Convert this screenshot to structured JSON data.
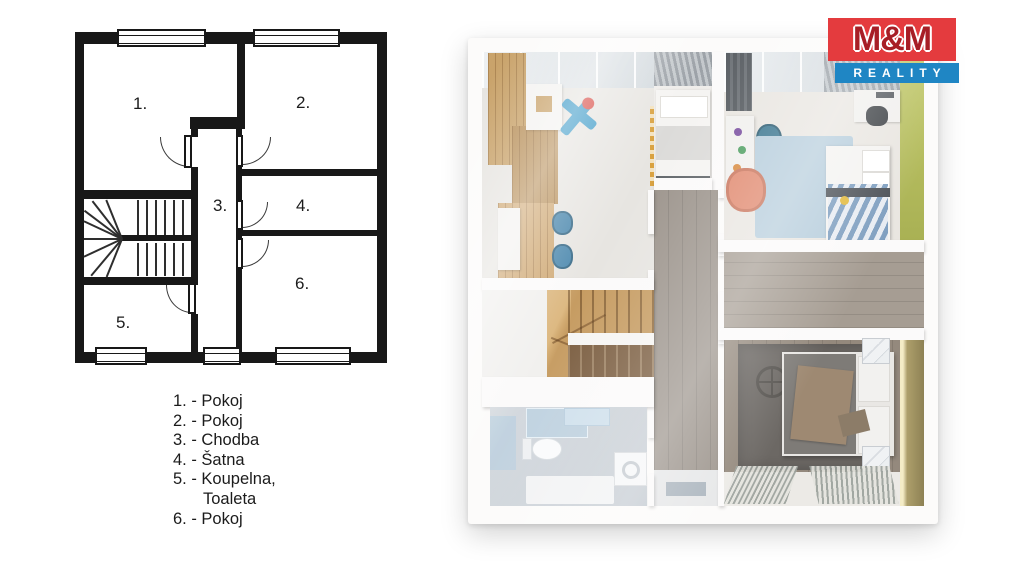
{
  "logo": {
    "line1": "M&M",
    "line2": "REALITY",
    "red": "#e43b3e",
    "letter_red": "#a81e26",
    "blue": "#1f86c4",
    "text_color": "#ffffff"
  },
  "plan2d": {
    "rooms": [
      {
        "number": "1.",
        "name": "Pokoj"
      },
      {
        "number": "2.",
        "name": "Pokoj"
      },
      {
        "number": "3.",
        "name": "Chodba"
      },
      {
        "number": "4.",
        "name": "Šatna"
      },
      {
        "number": "5.",
        "name": "Koupelna, Toaleta"
      },
      {
        "number": "6.",
        "name": "Pokoj"
      }
    ],
    "wall_color": "#181818"
  },
  "legend": {
    "items": [
      {
        "text": "1. - Pokoj"
      },
      {
        "text": "2. - Pokoj"
      },
      {
        "text": "3. - Chodba"
      },
      {
        "text": "4. - Šatna"
      },
      {
        "text": "5. - Koupelna,"
      },
      {
        "text": "Toaleta"
      },
      {
        "text": "6. - Pokoj"
      }
    ]
  },
  "plan3d": {
    "colors": {
      "accent_green_wall": "#b5bd5e",
      "accent_olive_wall": "#a79b69",
      "wood_wardrobe": "#c9a36b",
      "wood_stairs": "#c69c62",
      "corridor_floor": "#9c948c",
      "closet_floor": "#a69d93",
      "bedroom_floor": "#94897d",
      "rug_blue": "#b6cddc",
      "rug_dark": "#6c6864",
      "chair_coral": "#e18a70",
      "toy_plane_blue": "#3e9bc8",
      "bathroom_floor": "#cdd3d9"
    }
  }
}
